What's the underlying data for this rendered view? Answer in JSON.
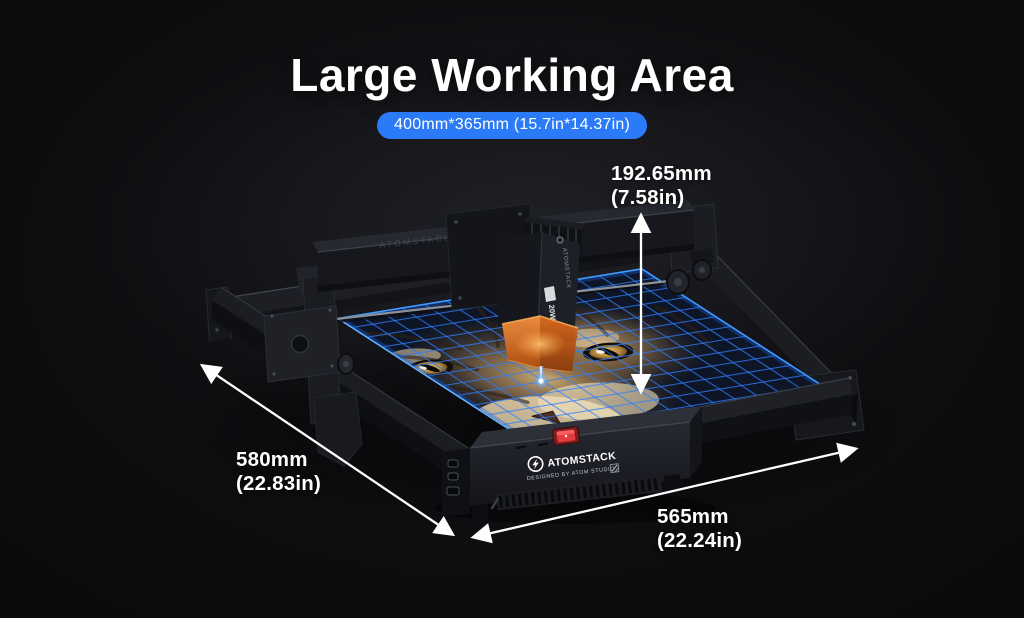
{
  "page": {
    "title": "Large Working Area",
    "badge": "400mm*365mm (15.7in*14.37in)"
  },
  "dimensions": {
    "height_mm": "192.65mm",
    "height_in": "(7.58in)",
    "depth_mm": "580mm",
    "depth_in": "(22.83in)",
    "width_mm": "565mm",
    "width_in": "(22.24in)"
  },
  "machine": {
    "brand": "ATOMSTACK",
    "tagline": "DESIGNED BY ATOM STUDIO",
    "beam_label": "ATOMSTACK",
    "module_brand": "ATOMSTACK",
    "module_power": "20W"
  },
  "colors": {
    "background": "#0a0a0c",
    "title_text": "#ffffff",
    "badge_blue": "#2b7af7",
    "grid_blue": "#2f7dff",
    "grid_border_glow": "#3fa2ff",
    "shield_orange": "#e4731f",
    "laser_blue": "#9fd4ff",
    "switch_red": "#e23c3e",
    "engraving_tan": "#c9a36d"
  }
}
